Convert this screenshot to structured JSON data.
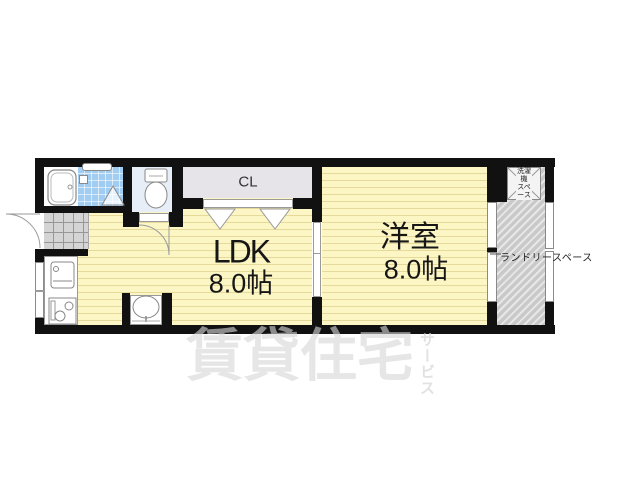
{
  "rooms": {
    "ldk": {
      "label": "LDK",
      "size": "8.0帖"
    },
    "western": {
      "label": "洋室",
      "size": "8.0帖"
    },
    "closet": {
      "label": "CL"
    },
    "washer_space": {
      "line1": "洗濯機",
      "line2": "スペース"
    },
    "laundry": {
      "label": "ランドリースペース"
    }
  },
  "watermark": {
    "main": "賃貸住宅",
    "sub": "サービス"
  },
  "colors": {
    "wall": "#111111",
    "room_yellow": "#fcf6c5",
    "shower_blue": "#a0cdf1",
    "toilet_blue": "#e7eef7",
    "closet_gray": "#e6e3e9",
    "genkan_gray": "#d4d4d4",
    "hatch_gray": "#c9c9c9",
    "watermark_gray": "#d7d7d7"
  }
}
